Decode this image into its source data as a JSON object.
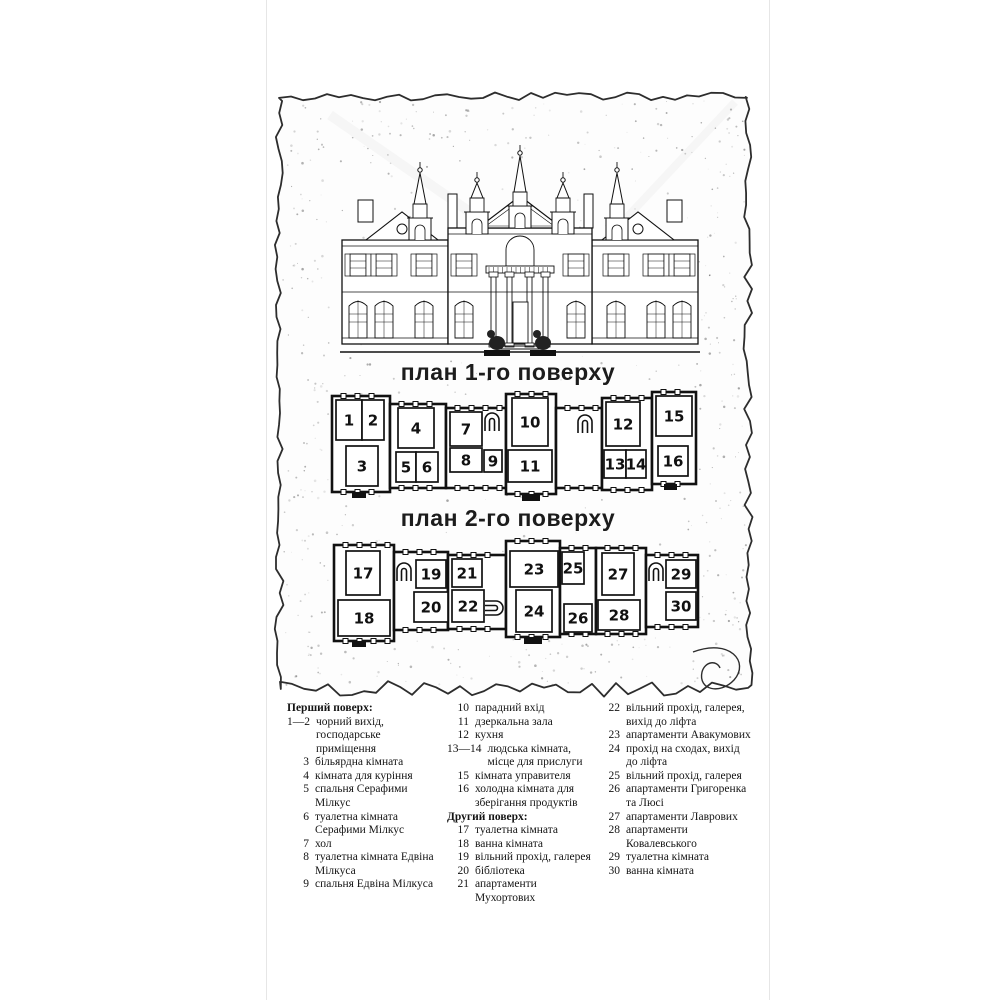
{
  "colors": {
    "ink": "#1c1c1c",
    "paper": "#fdfdfd",
    "wall": "#111111",
    "speckle": "#3a3a3a",
    "page_edge": "#e6e6e6"
  },
  "titles": {
    "plan1": "план 1-го поверху",
    "plan2": "план 2-го поверху"
  },
  "legend": {
    "columns": [
      {
        "items": [
          {
            "header": "Перший поверх:"
          },
          {
            "num": "1—2",
            "text": "чорний вихід, господарське приміщення"
          },
          {
            "num": "3",
            "text": "більярдна кімната"
          },
          {
            "num": "4",
            "text": "кімната для куріння"
          },
          {
            "num": "5",
            "text": "спальня Серафими Мілкус"
          },
          {
            "num": "6",
            "text": "туалетна кімната Серафими Мілкус"
          },
          {
            "num": "7",
            "text": "хол"
          },
          {
            "num": "8",
            "text": "туалетна кімната Едвіна Мілкуса"
          },
          {
            "num": "9",
            "text": "спальня Едвіна Мілкуса"
          }
        ]
      },
      {
        "items": [
          {
            "num": "10",
            "text": "парадний вхід"
          },
          {
            "num": "11",
            "text": "дзеркальна зала"
          },
          {
            "num": "12",
            "text": "кухня"
          },
          {
            "num": "13—14",
            "text": "людська кімната, місце для прислуги"
          },
          {
            "num": "15",
            "text": "кімната управителя"
          },
          {
            "num": "16",
            "text": "холодна кімната для зберігання продуктів"
          },
          {
            "header": "Другий поверх:"
          },
          {
            "num": "17",
            "text": "туалетна кімната"
          },
          {
            "num": "18",
            "text": "ванна кімната"
          },
          {
            "num": "19",
            "text": "вільний прохід, галерея"
          },
          {
            "num": "20",
            "text": "бібліотека"
          },
          {
            "num": "21",
            "text": "апартаменти Мухортових"
          }
        ]
      },
      {
        "items": [
          {
            "num": "22",
            "text": "вільний прохід, галерея, вихід до ліфта"
          },
          {
            "num": "23",
            "text": "апартаменти Авакумових"
          },
          {
            "num": "24",
            "text": "прохід на сходах, вихід до ліфта"
          },
          {
            "num": "25",
            "text": "вільний прохід, галерея"
          },
          {
            "num": "26",
            "text": "апартаменти Григоренка та Люсі"
          },
          {
            "num": "27",
            "text": "апартаменти Лаврових"
          },
          {
            "num": "28",
            "text": "апартаменти Ковалевського"
          },
          {
            "num": "29",
            "text": "туалетна кімната"
          },
          {
            "num": "30",
            "text": "ванна кімната"
          }
        ]
      }
    ]
  },
  "plan1": {
    "blocks": [
      [
        332,
        396,
        58,
        96
      ],
      [
        390,
        404,
        56,
        84
      ],
      [
        446,
        408,
        60,
        80
      ],
      [
        506,
        394,
        50,
        100
      ],
      [
        556,
        408,
        46,
        80
      ],
      [
        602,
        398,
        50,
        92
      ],
      [
        652,
        392,
        44,
        92
      ]
    ],
    "rooms": [
      {
        "label": "1",
        "x": 336,
        "y": 400,
        "w": 26,
        "h": 40
      },
      {
        "label": "2",
        "x": 362,
        "y": 400,
        "w": 22,
        "h": 40
      },
      {
        "label": "3",
        "x": 346,
        "y": 446,
        "w": 32,
        "h": 40
      },
      {
        "label": "4",
        "x": 398,
        "y": 408,
        "w": 36,
        "h": 40
      },
      {
        "label": "5",
        "x": 396,
        "y": 452,
        "w": 20,
        "h": 30
      },
      {
        "label": "6",
        "x": 416,
        "y": 452,
        "w": 22,
        "h": 30
      },
      {
        "label": "7",
        "x": 450,
        "y": 412,
        "w": 32,
        "h": 34
      },
      {
        "label": "8",
        "x": 450,
        "y": 448,
        "w": 32,
        "h": 24
      },
      {
        "label": "9",
        "x": 484,
        "y": 450,
        "w": 18,
        "h": 22
      },
      {
        "label": "10",
        "x": 512,
        "y": 398,
        "w": 36,
        "h": 48
      },
      {
        "label": "11",
        "x": 508,
        "y": 450,
        "w": 44,
        "h": 32
      },
      {
        "label": "12",
        "x": 606,
        "y": 402,
        "w": 34,
        "h": 44
      },
      {
        "label": "13",
        "x": 604,
        "y": 450,
        "w": 22,
        "h": 28
      },
      {
        "label": "14",
        "x": 626,
        "y": 450,
        "w": 20,
        "h": 28
      },
      {
        "label": "15",
        "x": 656,
        "y": 396,
        "w": 36,
        "h": 40
      },
      {
        "label": "16",
        "x": 658,
        "y": 446,
        "w": 30,
        "h": 30
      }
    ],
    "stairs": [
      {
        "cx": 492,
        "cy": 422,
        "rot": 0
      },
      {
        "cx": 585,
        "cy": 424,
        "rot": 0
      }
    ],
    "porches": [
      [
        522,
        494,
        18,
        7
      ],
      [
        352,
        492,
        14,
        6
      ],
      [
        664,
        484,
        13,
        6
      ]
    ]
  },
  "plan2": {
    "blocks": [
      [
        334,
        545,
        60,
        96
      ],
      [
        394,
        552,
        54,
        78
      ],
      [
        448,
        555,
        58,
        74
      ],
      [
        506,
        541,
        54,
        96
      ],
      [
        560,
        548,
        36,
        86
      ],
      [
        596,
        548,
        50,
        86
      ],
      [
        646,
        555,
        52,
        72
      ]
    ],
    "rooms": [
      {
        "label": "17",
        "x": 346,
        "y": 551,
        "w": 34,
        "h": 44
      },
      {
        "label": "18",
        "x": 338,
        "y": 600,
        "w": 52,
        "h": 36
      },
      {
        "label": "19",
        "x": 416,
        "y": 560,
        "w": 30,
        "h": 28
      },
      {
        "label": "20",
        "x": 414,
        "y": 592,
        "w": 34,
        "h": 30
      },
      {
        "label": "21",
        "x": 452,
        "y": 559,
        "w": 30,
        "h": 28
      },
      {
        "label": "22",
        "x": 452,
        "y": 590,
        "w": 32,
        "h": 32
      },
      {
        "label": "23",
        "x": 510,
        "y": 551,
        "w": 48,
        "h": 36
      },
      {
        "label": "24",
        "x": 516,
        "y": 590,
        "w": 36,
        "h": 42
      },
      {
        "label": "25",
        "x": 562,
        "y": 552,
        "w": 22,
        "h": 32
      },
      {
        "label": "26",
        "x": 564,
        "y": 604,
        "w": 28,
        "h": 28
      },
      {
        "label": "27",
        "x": 602,
        "y": 553,
        "w": 32,
        "h": 42
      },
      {
        "label": "28",
        "x": 598,
        "y": 600,
        "w": 42,
        "h": 30
      },
      {
        "label": "29",
        "x": 666,
        "y": 560,
        "w": 30,
        "h": 28
      },
      {
        "label": "30",
        "x": 666,
        "y": 592,
        "w": 30,
        "h": 28
      }
    ],
    "stairs": [
      {
        "cx": 404,
        "cy": 572,
        "rot": 0
      },
      {
        "cx": 656,
        "cy": 572,
        "rot": 0
      },
      {
        "cx": 494,
        "cy": 608,
        "rot": 90
      }
    ],
    "porches": [
      [
        524,
        637,
        18,
        7
      ],
      [
        352,
        641,
        14,
        6
      ]
    ]
  }
}
